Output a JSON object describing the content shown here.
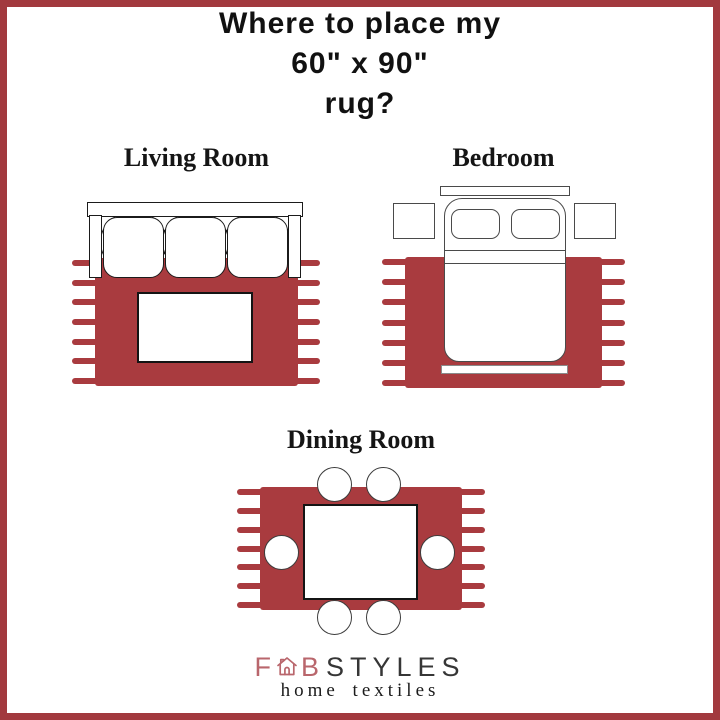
{
  "title": {
    "line1": "Where to place my",
    "line2": "60\" x 90\"",
    "line3": "rug?"
  },
  "rooms": {
    "living": {
      "label": "Living Room"
    },
    "bedroom": {
      "label": "Bedroom"
    },
    "dining": {
      "label": "Dining Room"
    }
  },
  "rug": {
    "size": "60\" x 90\"",
    "color": "#a93b3f",
    "fringe_count": 7
  },
  "frame_color": "#a2393e",
  "icons": {
    "logo_house": "house-icon"
  },
  "logo": {
    "prefix": "F",
    "suffix": "B",
    "styles": "STYLES",
    "tagline": "home textiles",
    "rose": "#b9666c",
    "dark": "#363636"
  }
}
